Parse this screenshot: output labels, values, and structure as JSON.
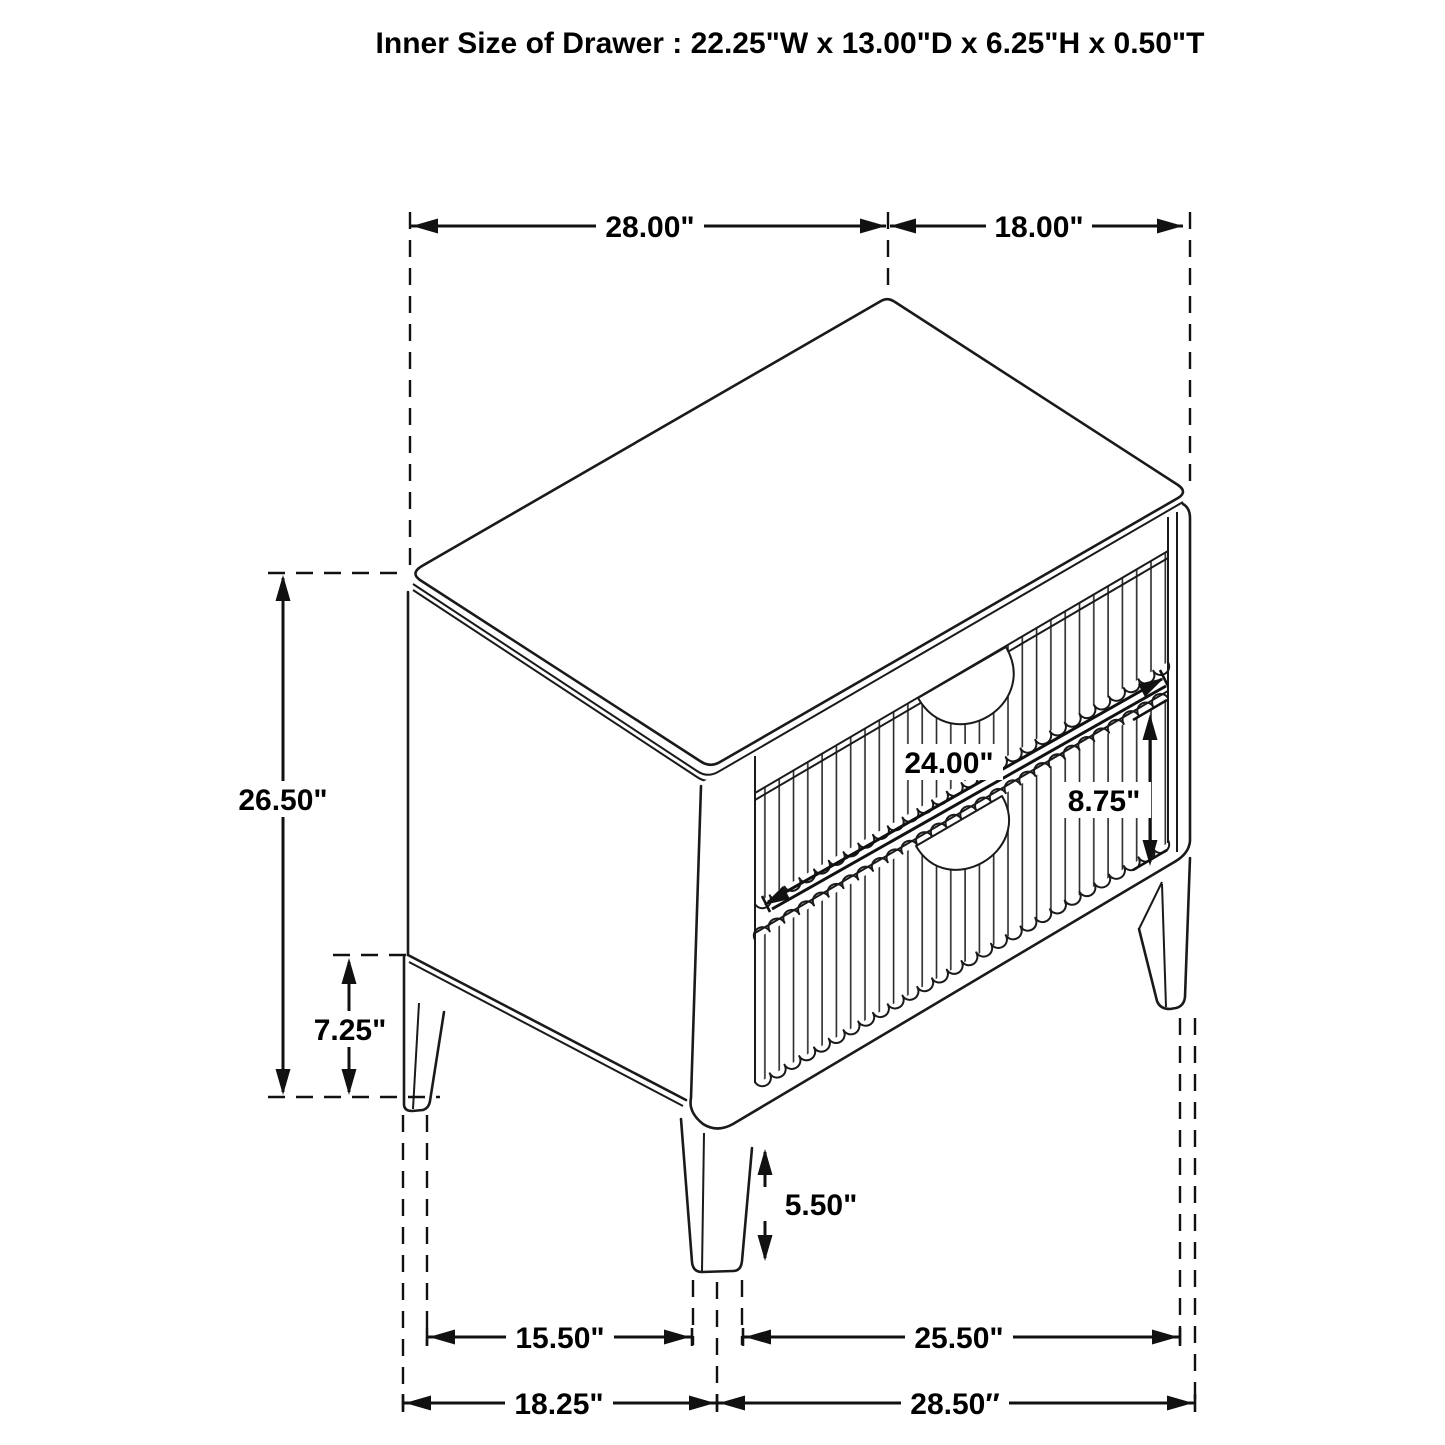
{
  "title": "Inner Size of Drawer : 22.25\"W x 13.00\"D x 6.25\"H x 0.50\"T",
  "figure": {
    "kind": "furniture dimension line drawing",
    "subject": "two-drawer nightstand, isometric view",
    "line_color": "#1a1a1a",
    "background": "#ffffff"
  },
  "dimensions": [
    {
      "id": "top-width",
      "label": "28.00\""
    },
    {
      "id": "top-depth",
      "label": "18.00\""
    },
    {
      "id": "overall-height",
      "label": "26.50\""
    },
    {
      "id": "base-clearance-height",
      "label": "7.25\""
    },
    {
      "id": "drawer-width",
      "label": "24.00\""
    },
    {
      "id": "drawer-front-height",
      "label": "8.75\""
    },
    {
      "id": "leg-height",
      "label": "5.50\""
    },
    {
      "id": "front-leg-span",
      "label": "15.50\""
    },
    {
      "id": "side-leg-span",
      "label": "25.50\""
    },
    {
      "id": "base-width",
      "label": "18.25\""
    },
    {
      "id": "base-depth",
      "label": "28.50″"
    }
  ]
}
